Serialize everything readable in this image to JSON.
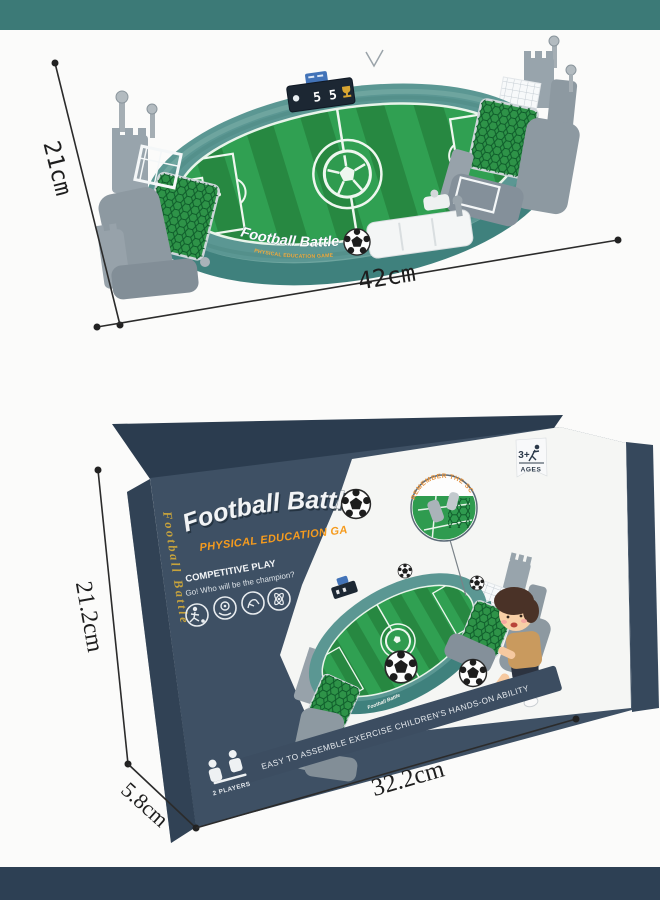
{
  "page": {
    "top_bar_color": "#3c7a77",
    "bottom_bar_color": "#2d4054",
    "background_color": "#fbfbfa"
  },
  "game_photo": {
    "rim_title": "Football Battle",
    "rim_subtitle": "PHYSICAL EDUCATION GAME",
    "scoreboard": {
      "left_score": "5",
      "right_score": "5"
    },
    "dim_height": "21cm",
    "dim_width": "42cm"
  },
  "box_photo": {
    "title": "Football Battle",
    "subtitle": "PHYSICAL EDUCATION GAME",
    "spine_title": "Football Battle",
    "competitive_heading": "COMPETITIVE PLAY",
    "competitive_sub": "Go! Who will be the champion?",
    "callout_text": "REMEMBER THE SCORE",
    "age_badge_age": "3+",
    "age_badge_label": "AGES",
    "bottom_banner": "EASY TO ASSEMBLE EXERCISE CHILDREN'S HANDS-ON ABILITY",
    "players_label": "2 PLAYERS",
    "mini_rim_title": "Football Battle",
    "dim_height": "21.2cm",
    "dim_width": "32.2cm",
    "dim_depth": "5.8cm"
  }
}
